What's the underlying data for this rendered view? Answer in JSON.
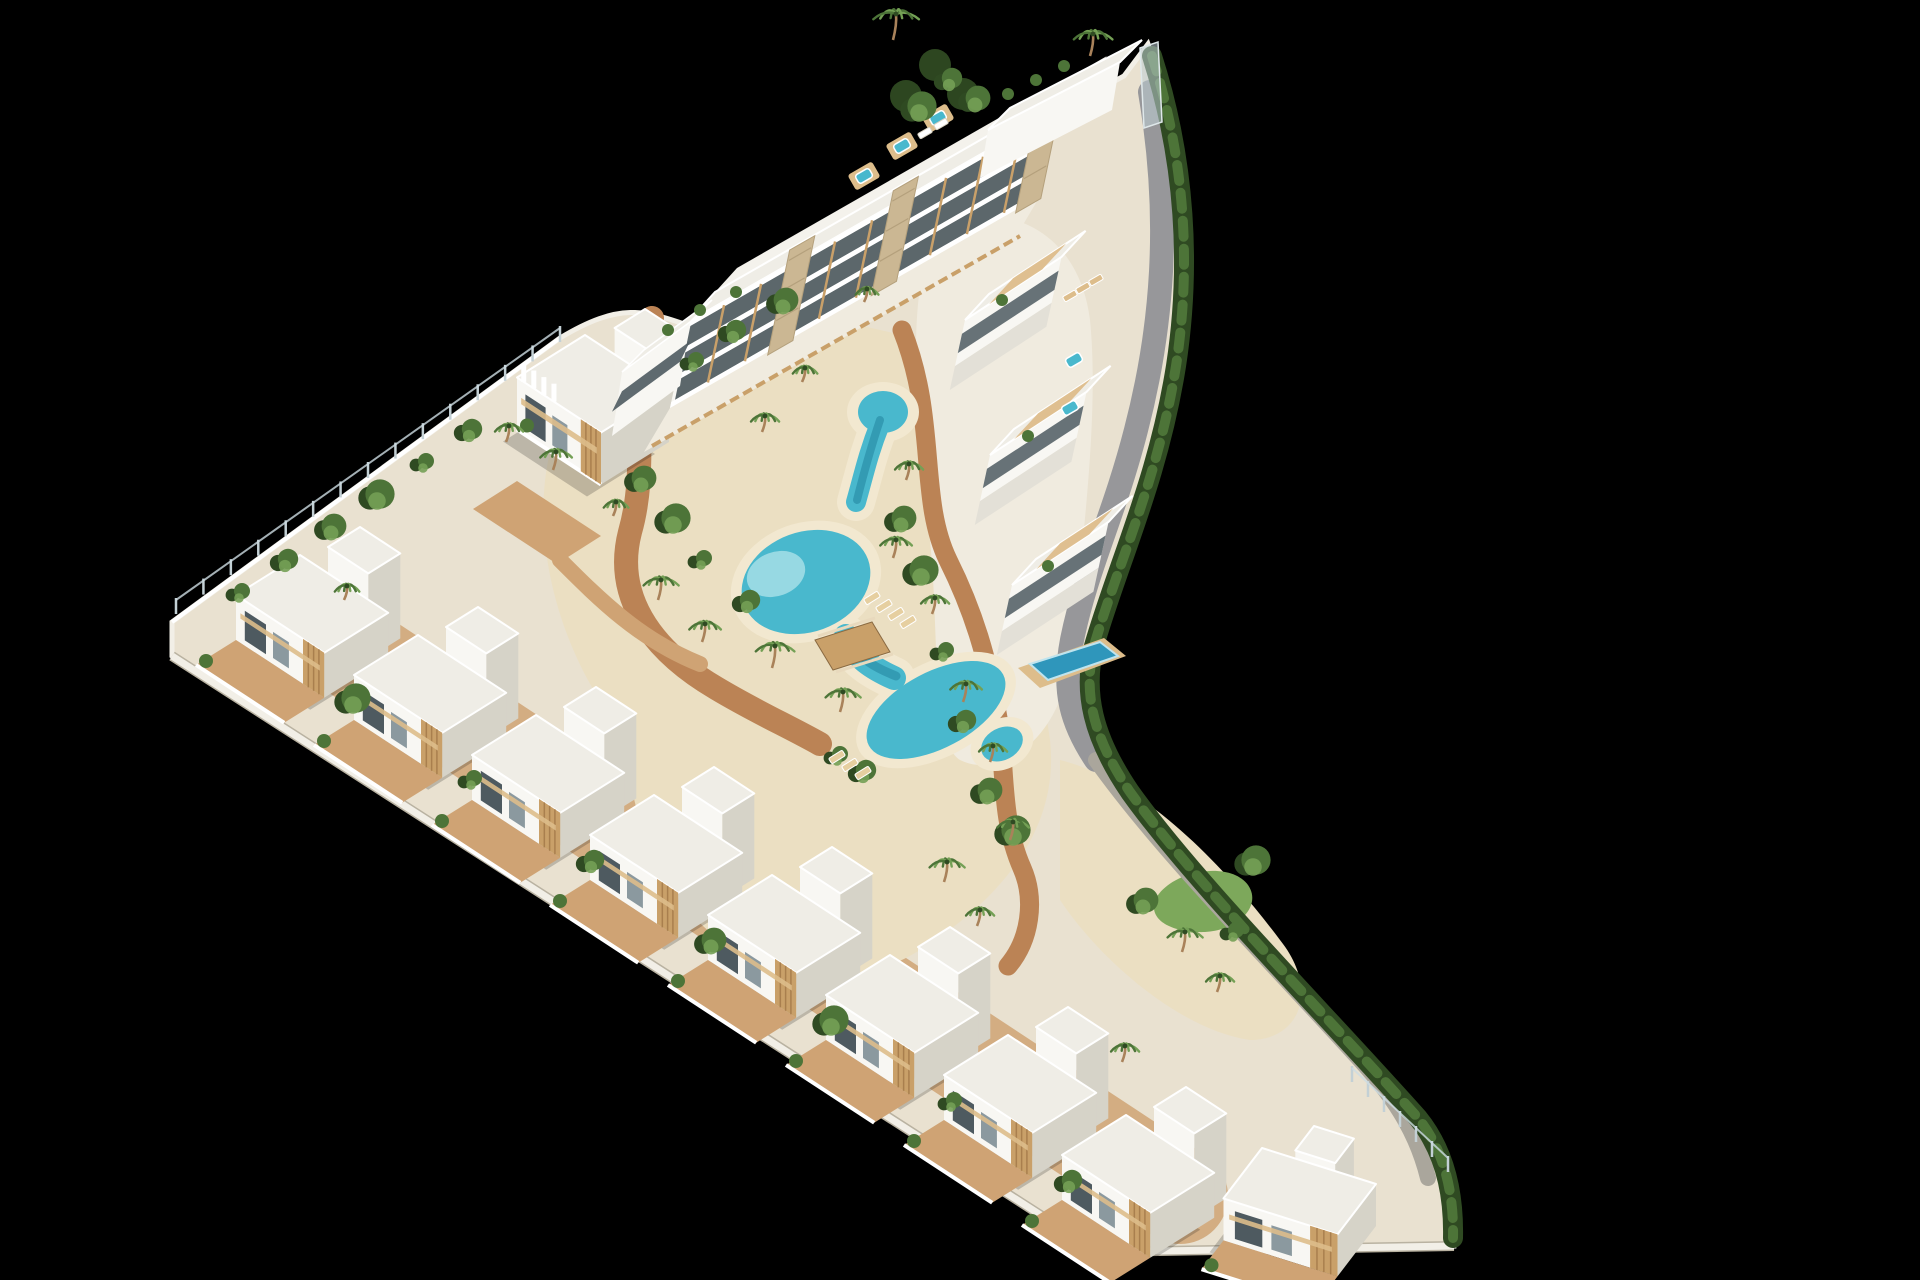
{
  "scene": {
    "type": "3d-aerial-architectural-render",
    "subject": "triangular coastal residential development with white villas and lazy-river pool",
    "background": "#000000",
    "palette": {
      "building": "#f8f7f3",
      "wallShade": "#e3e0d7",
      "wallDark": "#d6d3c8",
      "roof": "#efede6",
      "roofLight": "#f4f2ec",
      "glass": "#4e5a60",
      "glassLight": "#8b999f",
      "wood": "#c9a069",
      "woodLight": "#ddbd8b",
      "terracotta": "#bb8355",
      "terracottaLight": "#cfa374",
      "sand": "#ebdfc2",
      "sandLight": "#f2e8d0",
      "plaza": "#f0ebdf",
      "poolMain": "#49b8cd",
      "poolLight": "#a5dee6",
      "poolDeep": "#2e93ad",
      "privatePool": "#2f96bb",
      "green": "#4d7438",
      "greenDark": "#2f4a22",
      "greenLight": "#74a055",
      "lawn": "#7da85b",
      "road": "#97979a",
      "roadLight": "#aaa69c",
      "fencePost": "#c3d0d5",
      "stone": "#cbb793",
      "trunk": "#a9825a",
      "shadow": "rgba(10,12,10,0.20)",
      "plate": "#e9e1d0",
      "plateEdge": "#f2efe7"
    },
    "site": {
      "outline": "M172,622 L560,338 C620,302 644,310 690,326 L1058,112 L1124,76 L1148,44 C1186,152 1192,262 1177,362 C1159,478 1119,562 1094,645 C1082,692 1091,737 1129,793 C1196,885 1318,1006 1419,1119 C1447,1153 1457,1197 1454,1246 L1098,1252 L172,656 Z",
      "bottomWall": "M172,656 L1098,1252 L1454,1246",
      "topEdge": "M172,622 L560,338"
    },
    "groundZones": [
      {
        "name": "villa-terrace-band",
        "d": "M330,636 L1180,1196",
        "stroke": "terracottaLight",
        "width": 96,
        "opacity": 0.85
      },
      {
        "name": "central-sand",
        "d": "M560,420 C640,330 760,300 880,330 C980,350 1020,430 1010,520 C1000,600 1040,660 1050,740 C1060,830 1000,900 920,950 C840,1000 740,980 680,900 C620,820 640,760 600,700 C560,640 520,520 560,420 Z",
        "fill": "sand"
      },
      {
        "name": "right-plaza",
        "d": "M940,220 C1020,200 1080,240 1090,320 C1100,420 1080,560 1070,660 C1060,740 1000,780 960,760 C930,740 940,640 930,540 C920,420 900,300 940,220 Z",
        "fill": "plaza"
      },
      {
        "name": "corner-garden",
        "d": "M1060,760 C1140,780 1220,860 1280,940 C1320,990 1300,1040 1250,1040 C1180,1030 1100,960 1060,900 Z",
        "fill": "sand"
      },
      {
        "name": "lawn-patch",
        "d": "M1155,900 C1170,870 1230,860 1248,885 C1262,905 1240,930 1205,932 C1175,933 1148,922 1155,900 Z",
        "fill": "lawn"
      }
    ],
    "roads": [
      {
        "name": "perimeter-road",
        "d": "M1150,92 C1172,220 1162,330 1136,430 C1114,516 1086,570 1072,640 C1062,692 1072,724 1096,760",
        "width": 24,
        "color": "road"
      },
      {
        "name": "garden-walk",
        "d": "M1096,760 C1160,850 1260,950 1360,1060 C1400,1104 1418,1138 1428,1178",
        "width": 16,
        "color": "roadLight"
      }
    ],
    "paths": [
      {
        "name": "pool-walk-west",
        "d": "M652,318 C628,398 650,462 630,532 C614,594 648,648 716,688 C756,712 788,726 820,744",
        "width": 24,
        "color": "terracotta"
      },
      {
        "name": "pool-walk-east",
        "d": "M902,330 C938,420 918,498 948,560 C974,612 988,660 998,718 C1006,768 1000,818 1022,868 C1036,900 1030,940 1008,966",
        "width": 19,
        "color": "terracotta"
      },
      {
        "name": "court-link",
        "d": "M560,560 C600,600 640,640 700,664",
        "width": 16,
        "color": "terracottaLight"
      }
    ],
    "hedge": {
      "d": "M1152,56 C1186,162 1191,268 1176,366 C1158,480 1118,563 1094,646 C1083,692 1092,736 1130,792 C1196,884 1318,1006 1418,1118 C1444,1150 1454,1192 1453,1238",
      "width": 20
    },
    "topTreeCluster": [
      [
        935,
        65
      ],
      [
        963,
        94
      ],
      [
        906,
        96
      ]
    ],
    "pool": {
      "blobs": [
        {
          "cx": 883,
          "cy": 412,
          "rx": 25,
          "ry": 21,
          "rot": 0
        },
        {
          "cx": 806,
          "cy": 582,
          "rx": 66,
          "ry": 50,
          "rot": -20
        },
        {
          "cx": 936,
          "cy": 710,
          "rx": 76,
          "ry": 38,
          "rot": -28
        },
        {
          "cx": 1002,
          "cy": 744,
          "rx": 22,
          "ry": 16,
          "rot": -28
        }
      ],
      "channels": [
        {
          "d": "M880,424 C868,454 864,474 856,502",
          "w": 20
        },
        {
          "d": "M846,636 C856,658 872,668 894,678",
          "w": 24
        }
      ],
      "beach": {
        "cx": 776,
        "cy": 574,
        "rx": 30,
        "ry": 22,
        "rot": -20
      },
      "deep": [
        {
          "d": "M880,420 C870,450 864,472 857,500",
          "w": 8
        },
        {
          "d": "M850,640 C860,660 876,668 896,676",
          "w": 9
        }
      ],
      "bridge": {
        "deck": "M815,640 L872,622 L890,652 L833,670 Z",
        "railA": "M818,636 L875,618",
        "railB": "M836,672 L893,654"
      }
    },
    "privatePool": {
      "deck": "M1018,668 L1104,638 L1126,656 L1040,688 Z",
      "water": "M1030,664 L1100,642 L1118,656 L1048,680 Z"
    },
    "apartment": {
      "edge": [
        688,
        322,
        1058,
        110
      ],
      "faceH": 90,
      "skew": [
        -18,
        86
      ],
      "roofBack": [
        27,
        -30
      ],
      "roof2Back": [
        22,
        -24
      ],
      "mullions": 10,
      "cores": [
        0.3,
        0.58,
        0.97
      ],
      "leftWing": {
        "edge": [
          622,
          372,
          690,
          322
        ],
        "faceH": 64
      },
      "penthouse": {
        "face": "M988,130 L1120,62 L1112,110 L980,178 Z",
        "roof": "M988,130 L1120,62 L1142,40 L1010,108 Z"
      },
      "terrace": "M670,408 L1040,196 L1014,240 L644,452 Z",
      "fence": "M652,446 L1020,236",
      "jacuzzis": [
        [
          902,
          146
        ],
        [
          864,
          176
        ],
        [
          938,
          118
        ]
      ],
      "roofPlants": [
        [
          1008,
          94
        ],
        [
          1036,
          80
        ],
        [
          1064,
          66
        ],
        [
          700,
          310
        ],
        [
          668,
          330
        ],
        [
          736,
          292
        ]
      ],
      "loungers": [
        [
          925,
          133
        ],
        [
          941,
          124
        ]
      ]
    },
    "archHouse": {
      "x": 585,
      "y": 335,
      "a": 100,
      "b": 85,
      "h": 52,
      "towerDx": 60,
      "towerDy": -26,
      "towerA": 44,
      "towerB": 38,
      "towerH": 80,
      "fins": 4,
      "court": "M517,481 L601,536 L557,564 L473,509 Z",
      "courtPalms": [
        [
          560,
          512
        ],
        [
          598,
          538
        ]
      ]
    },
    "rightWing": {
      "units": [
        [
          965,
          320
        ],
        [
          990,
          455
        ],
        [
          1012,
          585
        ]
      ],
      "len": 115,
      "faceH": 46,
      "roofBack": [
        24,
        -26
      ],
      "jacuzzis": [
        [
          1074,
          360
        ],
        [
          1070,
          408
        ]
      ],
      "plants": [
        [
          1002,
          300
        ],
        [
          1028,
          436
        ],
        [
          1048,
          566
        ]
      ],
      "loungers": [
        [
          1070,
          296
        ],
        [
          1083,
          288
        ],
        [
          1096,
          280
        ]
      ]
    },
    "villas": {
      "axes": [
        0.84,
        0.55,
        -0.8,
        0.5
      ],
      "dims": {
        "a": 105,
        "b": 80,
        "h": 45
      },
      "tower": {
        "dx": 60,
        "dy": -28,
        "a": 48,
        "b": 40,
        "h": 85
      },
      "terrace": 50,
      "items": [
        [
          300,
          555
        ],
        [
          418,
          635
        ],
        [
          536,
          715
        ],
        [
          654,
          795
        ],
        [
          772,
          875
        ],
        [
          890,
          955
        ],
        [
          1008,
          1035
        ],
        [
          1126,
          1115
        ]
      ]
    },
    "endVilla": {
      "x": 1262,
      "y": 1148,
      "axes": [
        0.95,
        0.3,
        -0.55,
        0.72
      ],
      "a": 120,
      "b": 70,
      "h": 42
    },
    "fences": [
      {
        "a": [
          176,
          614
        ],
        "b": [
          560,
          342
        ],
        "posts": 14
      },
      {
        "a": [
          1352,
          1082
        ],
        "b": [
          1448,
          1172
        ],
        "posts": 6
      }
    ],
    "glassWall": "M1140,48 L1158,42 L1162,122 L1144,128 Z",
    "palms": [
      [
        893,
        40,
        26
      ],
      [
        1090,
        56,
        22
      ],
      [
        658,
        600,
        20
      ],
      [
        702,
        642,
        18
      ],
      [
        772,
        668,
        22
      ],
      [
        840,
        712,
        20
      ],
      [
        893,
        558,
        18
      ],
      [
        906,
        480,
        16
      ],
      [
        932,
        614,
        16
      ],
      [
        963,
        702,
        18
      ],
      [
        990,
        762,
        16
      ],
      [
        1010,
        840,
        18
      ],
      [
        944,
        882,
        20
      ],
      [
        977,
        926,
        16
      ],
      [
        553,
        470,
        18
      ],
      [
        506,
        442,
        16
      ],
      [
        613,
        516,
        14
      ],
      [
        1182,
        952,
        20
      ],
      [
        1217,
        992,
        16
      ],
      [
        762,
        432,
        16
      ],
      [
        802,
        382,
        14
      ],
      [
        1122,
        1062,
        16
      ],
      [
        344,
        600,
        14
      ],
      [
        864,
        302,
        13
      ]
    ],
    "bushes": [
      [
        238,
        593
      ],
      [
        284,
        561
      ],
      [
        330,
        528
      ],
      [
        376,
        496
      ],
      [
        422,
        463
      ],
      [
        468,
        431
      ],
      [
        640,
        480
      ],
      [
        672,
        520
      ],
      [
        700,
        560
      ],
      [
        746,
        602
      ],
      [
        900,
        520
      ],
      [
        920,
        572
      ],
      [
        942,
        652
      ],
      [
        962,
        722
      ],
      [
        986,
        792
      ],
      [
        1012,
        832
      ],
      [
        692,
        362
      ],
      [
        732,
        332
      ],
      [
        782,
        302
      ],
      [
        352,
        700
      ],
      [
        470,
        780
      ],
      [
        590,
        862
      ],
      [
        710,
        942
      ],
      [
        830,
        1022
      ],
      [
        950,
        1102
      ],
      [
        1068,
        1182
      ],
      [
        1142,
        902
      ],
      [
        1252,
        862
      ],
      [
        1232,
        932
      ],
      [
        948,
        80
      ],
      [
        974,
        100
      ],
      [
        918,
        108
      ],
      [
        836,
        756
      ],
      [
        862,
        772
      ]
    ],
    "beachLoungers": [
      [
        872,
        598
      ],
      [
        884,
        606
      ],
      [
        896,
        614
      ],
      [
        908,
        622
      ],
      [
        837,
        757
      ],
      [
        850,
        765
      ],
      [
        863,
        773
      ]
    ]
  }
}
